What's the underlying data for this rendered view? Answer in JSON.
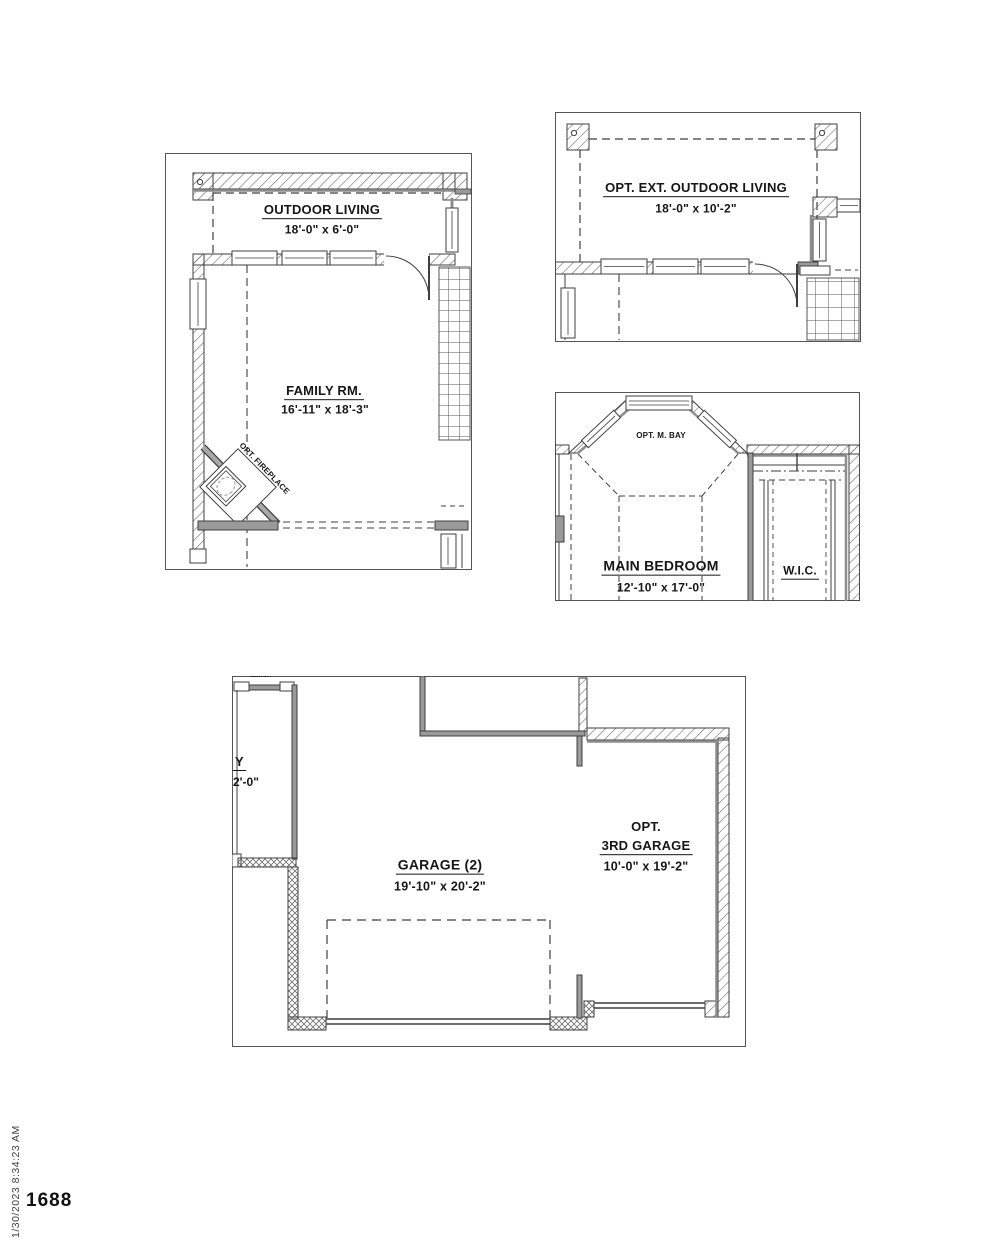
{
  "sheet": {
    "number": "1688",
    "timestamp": "1/30/2023 8:34:23 AM"
  },
  "plans": {
    "family_room_plan": {
      "outdoor_living": {
        "name": "OUTDOOR LIVING",
        "dims": "18'-0\" x 6'-0\""
      },
      "family_rm": {
        "name": "FAMILY RM.",
        "dims": "16'-11\" x 18'-3\""
      },
      "fireplace_label": "OPT. FIREPLACE"
    },
    "opt_ext_outdoor_living_plan": {
      "name": "OPT. EXT. OUTDOOR LIVING",
      "dims": "18'-0\" x 10'-2\""
    },
    "main_bedroom_plan": {
      "bay_label": "OPT. M. BAY",
      "name": "MAIN BEDROOM",
      "dims": "12'-10\" x 17'-0\"",
      "wic_label": "W.I.C."
    },
    "garage_plan": {
      "clipped_top_label": "BENCH",
      "clipped_room": {
        "name_fragment": "Y",
        "dims_fragment": "2'-0\""
      },
      "garage_2": {
        "name": "GARAGE (2)",
        "dims": "19'-10\" x 20'-2\""
      },
      "opt_3rd_garage": {
        "line1": "OPT.",
        "line2": "3RD GARAGE",
        "dims": "10'-0\" x 19'-2\""
      }
    }
  },
  "colors": {
    "line": "#3f3f3f",
    "wall_gray": "#9a9a9a",
    "text": "#161616"
  }
}
